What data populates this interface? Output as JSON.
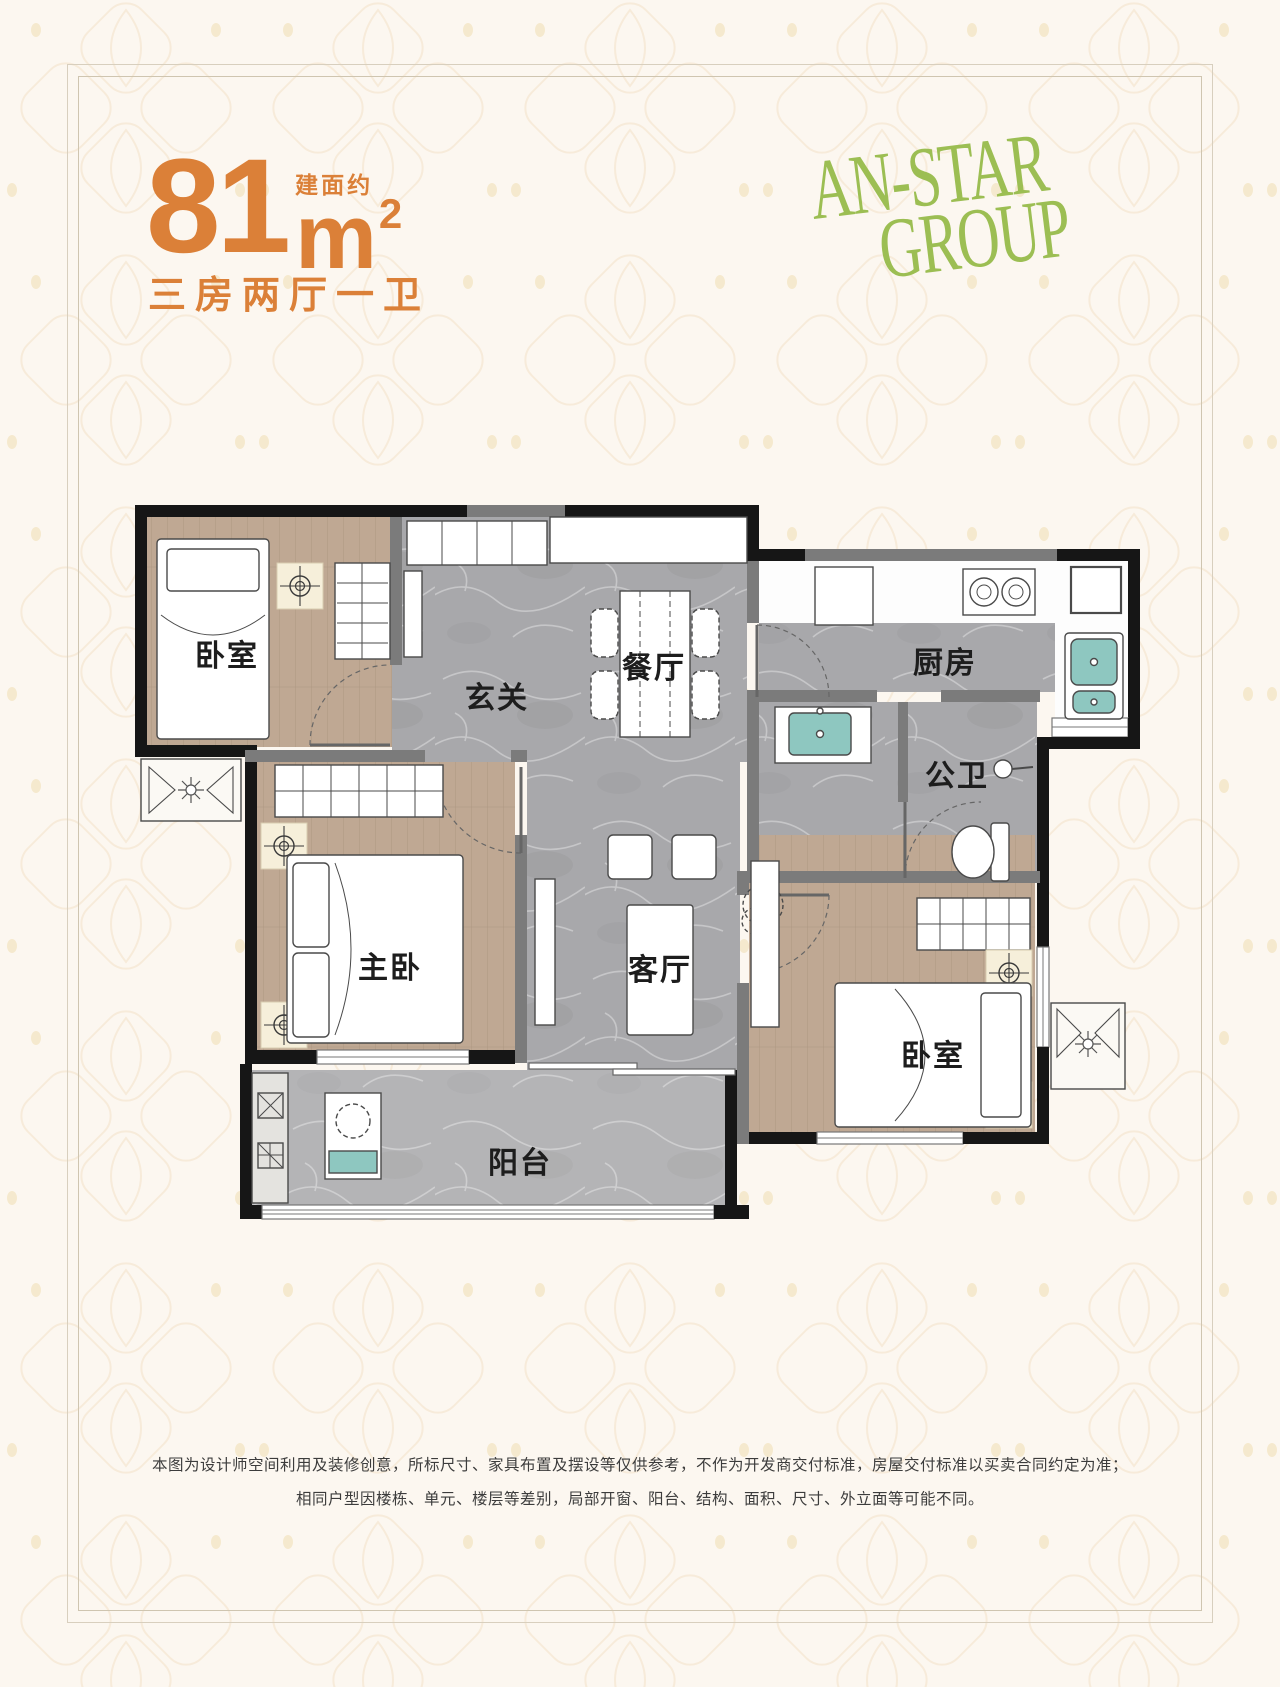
{
  "header": {
    "area_value": "81",
    "area_unit": "m",
    "area_sup": "2",
    "area_prefix": "建面约",
    "layout_desc": "三房两厅一卫"
  },
  "logo": {
    "line1": "AN-STAR",
    "line2": "GROUP"
  },
  "floorplan": {
    "rooms": [
      {
        "id": "bedroom-top-left",
        "label": "卧室"
      },
      {
        "id": "entry-hall",
        "label": "玄关"
      },
      {
        "id": "dining-room",
        "label": "餐厅"
      },
      {
        "id": "kitchen",
        "label": "厨房"
      },
      {
        "id": "bathroom",
        "label": "公卫"
      },
      {
        "id": "master-bedroom",
        "label": "主卧"
      },
      {
        "id": "living-room",
        "label": "客厅"
      },
      {
        "id": "bedroom-bottom-right",
        "label": "卧室"
      },
      {
        "id": "balcony",
        "label": "阳台"
      }
    ]
  },
  "footer": {
    "disclaimer_line1": "本图为设计师空间利用及装修创意，所标尺寸、家具布置及摆设等仅供参考，不作为开发商交付标准，房屋交付标准以买卖合同约定为准；",
    "disclaimer_line2": "相同户型因楼栋、单元、楼层等差别，局部开窗、阳台、结构、面积、尺寸、外立面等可能不同。"
  },
  "colors": {
    "accent_orange": "#DB8038",
    "logo_green": "#9CBE53",
    "wall_black": "#161616",
    "wall_gray": "#7B7B7B",
    "floor_marble": "#A8A8AB",
    "floor_wood": "#BFA893",
    "fixture_teal": "#8EC7C0",
    "background": "#FCF7F0",
    "frame_line": "#D8CFBE"
  }
}
